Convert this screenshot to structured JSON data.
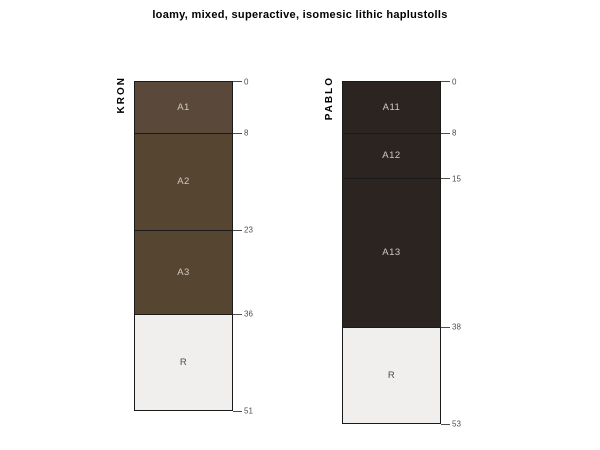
{
  "chart_data": {
    "type": "table",
    "subtype": "soil-profile-sketch",
    "title": "loamy, mixed, superactive, isomesic lithic haplustolls",
    "depth_units": "cm",
    "profiles": [
      {
        "id": "KRON",
        "depth_ticks": [
          0,
          8,
          23,
          36,
          51
        ],
        "horizons": [
          {
            "name": "A1",
            "top": 0,
            "bottom": 8,
            "color": "#5a493a",
            "label_color": "#cfcac4"
          },
          {
            "name": "A2",
            "top": 8,
            "bottom": 23,
            "color": "#564530",
            "label_color": "#cfcac4"
          },
          {
            "name": "A3",
            "top": 23,
            "bottom": 36,
            "color": "#564530",
            "label_color": "#cfcac4"
          },
          {
            "name": "R",
            "top": 36,
            "bottom": 51,
            "color": "#f0efee",
            "label_color": "#4d4d4d"
          }
        ]
      },
      {
        "id": "PABLO",
        "depth_ticks": [
          0,
          8,
          15,
          38,
          53
        ],
        "horizons": [
          {
            "name": "A11",
            "top": 0,
            "bottom": 8,
            "color": "#2b2420",
            "label_color": "#cfcac4"
          },
          {
            "name": "A12",
            "top": 8,
            "bottom": 15,
            "color": "#2b2420",
            "label_color": "#cfcac4"
          },
          {
            "name": "A13",
            "top": 15,
            "bottom": 38,
            "color": "#2b2420",
            "label_color": "#cfcac4"
          },
          {
            "name": "R",
            "top": 38,
            "bottom": 53,
            "color": "#f0efee",
            "label_color": "#4d4d4d"
          }
        ]
      }
    ],
    "layout": {
      "top_px": 81,
      "px_per_cm": 6.47,
      "profile_width_px": 99,
      "profile_left_px": [
        134,
        342
      ],
      "tick_len_px": 9,
      "boundary_color": "#1a1a1a",
      "tick_color": "#4d4d4d",
      "background": "#ffffff"
    }
  }
}
